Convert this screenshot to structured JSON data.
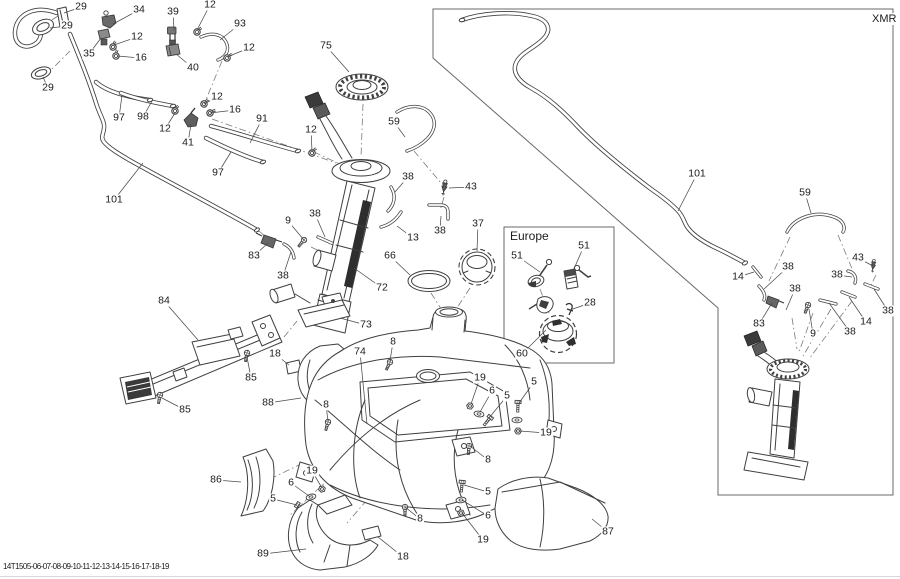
{
  "figure": {
    "xmr_label": "XMR",
    "europe_label": "Europe",
    "bottom_code": "14T1505-06-07-08-09-10-11-12-13-14-15-16-17-18-19"
  },
  "callouts": [
    {
      "text": "29",
      "x": 81,
      "y": 7,
      "tx": 64,
      "ty": 13
    },
    {
      "text": "29",
      "x": 67,
      "y": 26,
      "tx": 50,
      "ty": 28
    },
    {
      "text": "34",
      "x": 139,
      "y": 10,
      "tx": 113,
      "ty": 24
    },
    {
      "text": "39",
      "x": 173,
      "y": 12,
      "tx": 174,
      "ty": 30
    },
    {
      "text": "12",
      "x": 210,
      "y": 5,
      "tx": 197,
      "ty": 30
    },
    {
      "text": "93",
      "x": 240,
      "y": 24,
      "tx": 220,
      "ty": 40
    },
    {
      "text": "12",
      "x": 137,
      "y": 37,
      "tx": 114,
      "ty": 45
    },
    {
      "text": "35",
      "x": 89,
      "y": 54,
      "tx": 101,
      "ty": 38
    },
    {
      "text": "16",
      "x": 141,
      "y": 58,
      "tx": 117,
      "ty": 56
    },
    {
      "text": "40",
      "x": 193,
      "y": 68,
      "tx": 176,
      "ty": 54
    },
    {
      "text": "12",
      "x": 249,
      "y": 48,
      "tx": 227,
      "ty": 57
    },
    {
      "text": "29",
      "x": 48,
      "y": 88,
      "tx": 43,
      "ty": 77
    },
    {
      "text": "97",
      "x": 119,
      "y": 118,
      "tx": 122,
      "ty": 95
    },
    {
      "text": "98",
      "x": 143,
      "y": 117,
      "tx": 152,
      "ty": 101
    },
    {
      "text": "12",
      "x": 165,
      "y": 129,
      "tx": 175,
      "ty": 113
    },
    {
      "text": "41",
      "x": 188,
      "y": 143,
      "tx": 191,
      "ty": 124
    },
    {
      "text": "12",
      "x": 217,
      "y": 97,
      "tx": 204,
      "ty": 104
    },
    {
      "text": "16",
      "x": 235,
      "y": 110,
      "tx": 210,
      "ty": 113
    },
    {
      "text": "91",
      "x": 262,
      "y": 119,
      "tx": 250,
      "ty": 143
    },
    {
      "text": "97",
      "x": 218,
      "y": 173,
      "tx": 231,
      "ty": 152
    },
    {
      "text": "101",
      "x": 114,
      "y": 200,
      "tx": 143,
      "ty": 163
    },
    {
      "text": "75",
      "x": 326,
      "y": 46,
      "tx": 349,
      "ty": 72
    },
    {
      "text": "12",
      "x": 311,
      "y": 130,
      "tx": 312,
      "ty": 151
    },
    {
      "text": "59",
      "x": 394,
      "y": 122,
      "tx": 405,
      "ty": 137
    },
    {
      "text": "38",
      "x": 408,
      "y": 177,
      "tx": 395,
      "ty": 192
    },
    {
      "text": "43",
      "x": 471,
      "y": 187,
      "tx": 449,
      "ty": 188
    },
    {
      "text": "38",
      "x": 440,
      "y": 231,
      "tx": 441,
      "ty": 216
    },
    {
      "text": "13",
      "x": 413,
      "y": 238,
      "tx": 397,
      "ty": 226
    },
    {
      "text": "38",
      "x": 315,
      "y": 214,
      "tx": 325,
      "ty": 237
    },
    {
      "text": "9",
      "x": 288,
      "y": 221,
      "tx": 304,
      "ty": 240
    },
    {
      "text": "83",
      "x": 254,
      "y": 256,
      "tx": 268,
      "ty": 243
    },
    {
      "text": "38",
      "x": 283,
      "y": 276,
      "tx": 291,
      "ty": 252
    },
    {
      "text": "66",
      "x": 390,
      "y": 256,
      "tx": 410,
      "ty": 275
    },
    {
      "text": "37",
      "x": 478,
      "y": 224,
      "tx": 477,
      "ty": 251
    },
    {
      "text": "72",
      "x": 382,
      "y": 288,
      "tx": 354,
      "ty": 268
    },
    {
      "text": "73",
      "x": 366,
      "y": 325,
      "tx": 340,
      "ty": 318
    },
    {
      "text": "84",
      "x": 164,
      "y": 301,
      "tx": 198,
      "ty": 340
    },
    {
      "text": "85",
      "x": 251,
      "y": 378,
      "tx": 247,
      "ty": 357
    },
    {
      "text": "85",
      "x": 185,
      "y": 410,
      "tx": 162,
      "ty": 398
    },
    {
      "text": "18",
      "x": 275,
      "y": 354,
      "tx": 289,
      "ty": 365
    },
    {
      "text": "88",
      "x": 268,
      "y": 403,
      "tx": 301,
      "ty": 398
    },
    {
      "text": "74",
      "x": 360,
      "y": 352,
      "tx": 367,
      "ty": 424
    },
    {
      "text": "8",
      "x": 393,
      "y": 342,
      "tx": 390,
      "ty": 361
    },
    {
      "text": "19",
      "x": 480,
      "y": 378,
      "tx": 471,
      "ty": 404
    },
    {
      "text": "6",
      "x": 492,
      "y": 391,
      "tx": 480,
      "ty": 412
    },
    {
      "text": "5",
      "x": 507,
      "y": 396,
      "tx": 489,
      "ty": 418
    },
    {
      "text": "5",
      "x": 534,
      "y": 382,
      "tx": 519,
      "ty": 403
    },
    {
      "text": "8",
      "x": 326,
      "y": 405,
      "tx": 328,
      "ty": 421
    },
    {
      "text": "19",
      "x": 312,
      "y": 471,
      "tx": 322,
      "ty": 488
    },
    {
      "text": "6",
      "x": 291,
      "y": 483,
      "tx": 309,
      "ty": 496
    },
    {
      "text": "5",
      "x": 273,
      "y": 499,
      "tx": 297,
      "ty": 505
    },
    {
      "text": "86",
      "x": 216,
      "y": 480,
      "tx": 241,
      "ty": 482
    },
    {
      "text": "89",
      "x": 263,
      "y": 554,
      "tx": 306,
      "ty": 549
    },
    {
      "text": "18",
      "x": 403,
      "y": 557,
      "tx": 378,
      "ty": 537
    },
    {
      "text": "8",
      "x": 420,
      "y": 519,
      "tx": 405,
      "ty": 507
    },
    {
      "text": "8",
      "x": 488,
      "y": 460,
      "tx": 470,
      "ty": 446
    },
    {
      "text": "5",
      "x": 488,
      "y": 492,
      "tx": 464,
      "ty": 485
    },
    {
      "text": "6",
      "x": 488,
      "y": 516,
      "tx": 462,
      "ty": 500
    },
    {
      "text": "19",
      "x": 483,
      "y": 540,
      "tx": 462,
      "ty": 513
    },
    {
      "text": "19",
      "x": 546,
      "y": 433,
      "tx": 520,
      "ty": 431
    },
    {
      "text": "87",
      "x": 608,
      "y": 532,
      "tx": 592,
      "ty": 519
    },
    {
      "text": "51",
      "x": 517,
      "y": 256,
      "tx": 540,
      "ty": 272
    },
    {
      "text": "51",
      "x": 584,
      "y": 246,
      "tx": 573,
      "ty": 271
    },
    {
      "text": "28",
      "x": 590,
      "y": 303,
      "tx": 570,
      "ty": 310
    },
    {
      "text": "60",
      "x": 522,
      "y": 354,
      "tx": 546,
      "ty": 330
    },
    {
      "text": "101",
      "x": 697,
      "y": 174,
      "tx": 678,
      "ty": 211
    },
    {
      "text": "59",
      "x": 805,
      "y": 193,
      "tx": 811,
      "ty": 213
    },
    {
      "text": "14",
      "x": 738,
      "y": 277,
      "tx": 754,
      "ty": 272
    },
    {
      "text": "38",
      "x": 788,
      "y": 267,
      "tx": 764,
      "ty": 289
    },
    {
      "text": "43",
      "x": 858,
      "y": 258,
      "tx": 873,
      "ty": 266
    },
    {
      "text": "38",
      "x": 837,
      "y": 275,
      "tx": 852,
      "ty": 277
    },
    {
      "text": "38",
      "x": 795,
      "y": 289,
      "tx": 786,
      "ty": 310
    },
    {
      "text": "83",
      "x": 759,
      "y": 324,
      "tx": 772,
      "ty": 303
    },
    {
      "text": "9",
      "x": 813,
      "y": 334,
      "tx": 809,
      "ty": 309
    },
    {
      "text": "38",
      "x": 850,
      "y": 332,
      "tx": 829,
      "ty": 303
    },
    {
      "text": "14",
      "x": 866,
      "y": 322,
      "tx": 849,
      "ty": 297
    },
    {
      "text": "38",
      "x": 888,
      "y": 311,
      "tx": 874,
      "ty": 289
    }
  ]
}
